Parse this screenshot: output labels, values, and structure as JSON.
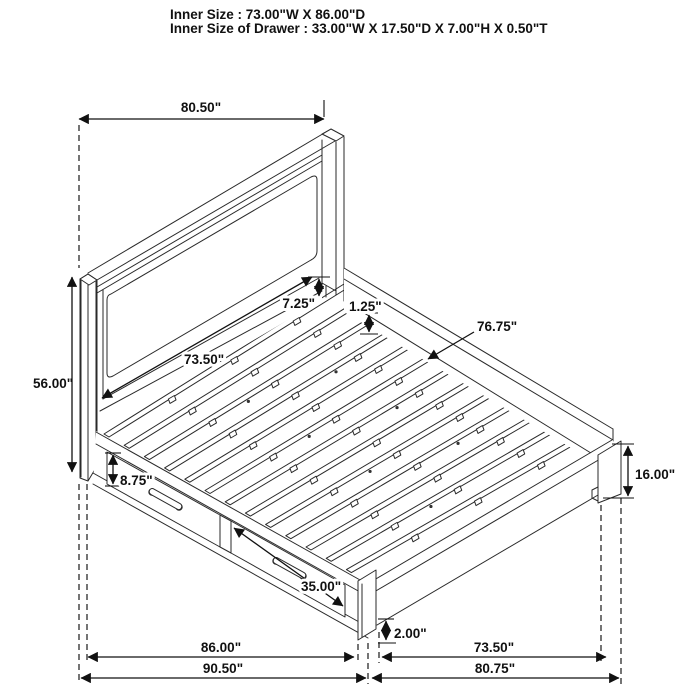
{
  "title": {
    "line1": "Inner Size : 73.00\"W X 86.00\"D",
    "line2": "Inner Size of Drawer : 33.00\"W X 17.50\"D X 7.00\"H X 0.50\"T"
  },
  "dimensions": {
    "headboard_width": "80.50\"",
    "headboard_height": "56.00\"",
    "post_exposed_height": "7.25\"",
    "slat_thickness": "1.25\"",
    "slat_length": "76.75\"",
    "headboard_inner_width": "73.50\"",
    "drawer_front_height": "8.75\"",
    "drawer_front_width": "35.00\"",
    "footboard_height": "16.00\"",
    "floor_clearance": "2.00\"",
    "side_rail_length": "86.00\"",
    "footboard_inner_width": "73.50\"",
    "overall_depth": "90.50\"",
    "overall_width": "80.75\""
  },
  "colors": {
    "line": "#2a2a2a",
    "background": "#ffffff"
  }
}
